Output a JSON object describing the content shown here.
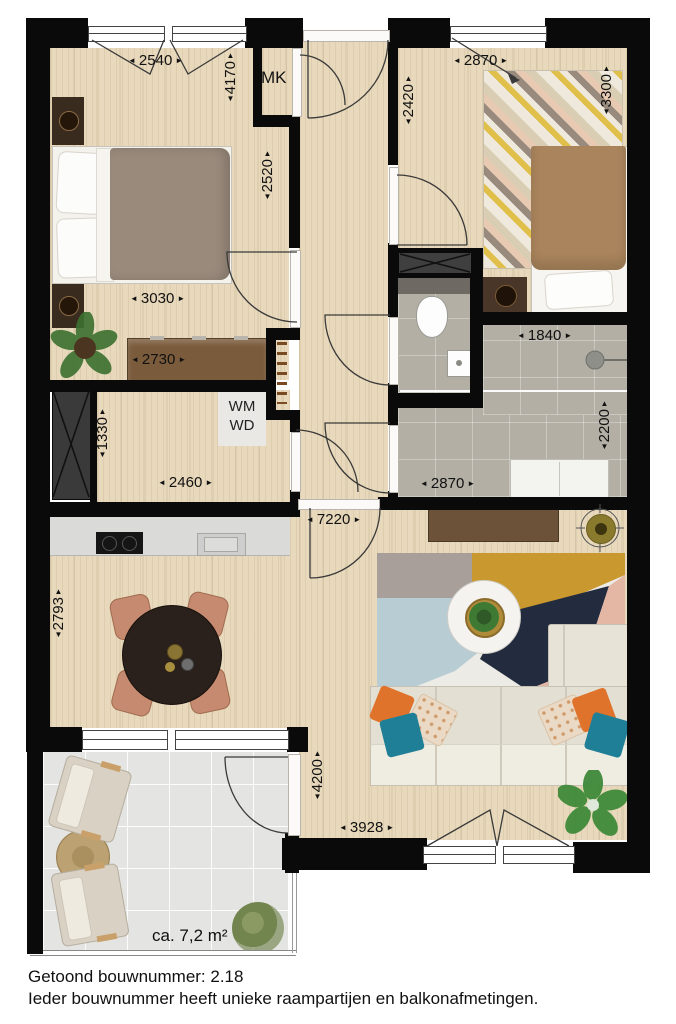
{
  "palette": {
    "wall": "#0a0a0a",
    "wood_floor": "#e8d9bc",
    "bathroom_tile": "#b3afa5",
    "balcony_tile": "#e4e4e2",
    "dimension_text": "#111111",
    "duvet_double": "#9a8a7c",
    "duvet_single": "#a9845c",
    "sofa": "#e7e3d7",
    "pillow_orange": "#e0732c",
    "pillow_teal": "#1f7f96",
    "chair_salmon": "#c58a70",
    "rug_mustard": "#c9982e",
    "rug_navy": "#232b3f",
    "rug_pink": "#e3b7a4",
    "rug_blue": "#b8ccd4",
    "rug_gray": "#a89f9a"
  },
  "labels": {
    "mk": "MK",
    "wm": "WM",
    "wd": "WD",
    "balcony_area": "ca. 7,2 m²"
  },
  "dims": {
    "d2540": "2540",
    "d4170": "4170",
    "d2520": "2520",
    "d3030": "3030",
    "d2730": "2730",
    "d2870_top": "2870",
    "d2420": "2420",
    "d3300": "3300",
    "d1840": "1840",
    "d1330": "1330",
    "d2460": "2460",
    "d2200": "2200",
    "d2870_bath": "2870",
    "d7220": "7220",
    "d2793": "2793",
    "d4200": "4200",
    "d3928": "3928"
  },
  "arrows": {
    "left": "◄",
    "right": "►",
    "up": "▲",
    "down": "▼"
  },
  "caption": {
    "line1": "Getoond bouwnummer: 2.18",
    "line2": "Ieder bouwnummer heeft unieke raampartijen en balkonafmetingen."
  }
}
